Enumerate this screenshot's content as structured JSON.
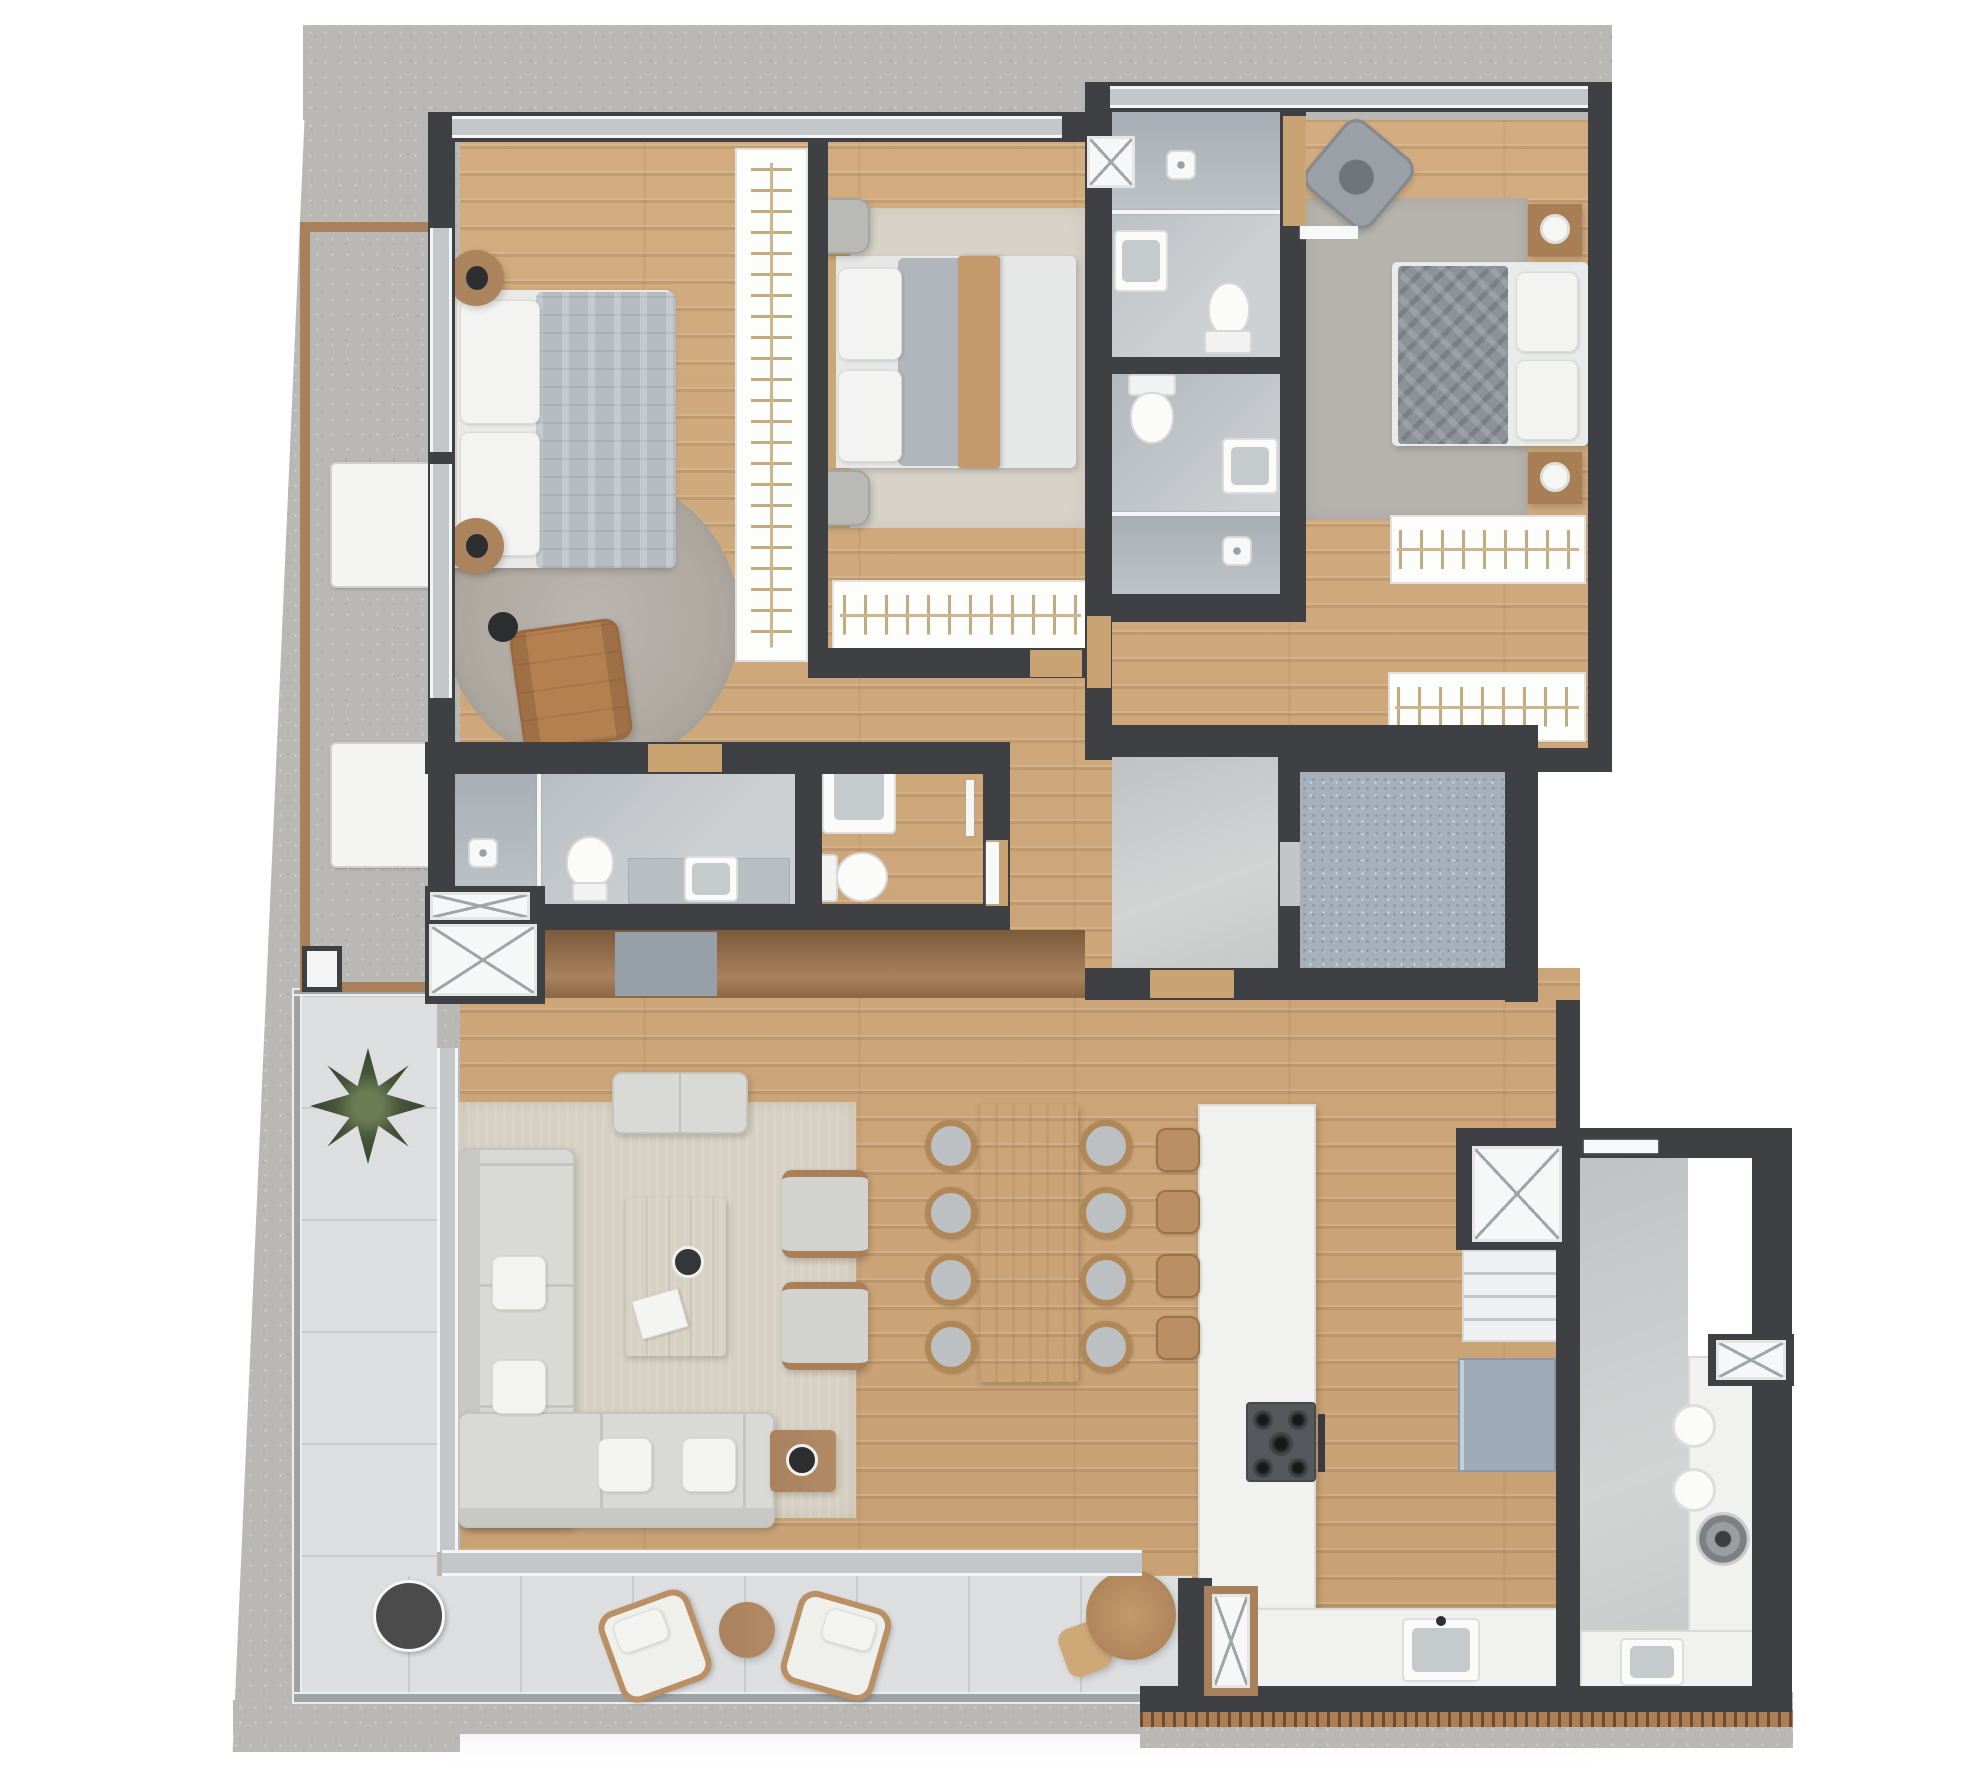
{
  "canvas": {
    "width": 1985,
    "height": 1769
  },
  "palette": {
    "background": "#ffffff",
    "concrete_surround": "#b9b8b5",
    "wall_dark": "#3e4043",
    "wood_floor": "#cba67a",
    "terrace_tile": "#dcdee0",
    "bathroom_floor": "#bcc1c6",
    "shaft_speckle": "#a6b0bb",
    "fixture_white": "#fbfbfa",
    "furniture_wood": "#a9815e",
    "leather_tan": "#b5804f",
    "duvet_gray": "#8b9298",
    "sofa_gray": "#d9d9d5",
    "deck_wood": "#ad7f55"
  },
  "plan": {
    "type": "residential apartment floor plan, 3D top-down render, no text labels",
    "rooms": {
      "bedroom1": "Bedroom with double bed, round rug and leather armchair",
      "bedroom2": "Bedroom with double bed and wardrobe",
      "bedroom3": "Bedroom with double bed, armchair and clothes racks",
      "wardrobe": "Walk-through wardrobe rail",
      "bathroom_a": "Bathroom with shower, vanity and toilet",
      "bathroom_b": "Bathroom with toilet, vanity and shower",
      "master_bathroom": "Bathroom with shower, toilet and vanity counter",
      "powder_room": "Toilet room with sink",
      "hall": "Internal hallway",
      "foyer": "Foyer with smooth gray floor",
      "shaft": "Elevator / stair shaft with speckled floor",
      "living": "Living room with corner sofa",
      "dining": "Dining area with table for eight",
      "kitchen": "Kitchen with island and counters",
      "service": "Service / laundry wing",
      "corridor": "Service corridor",
      "terrace": "L-shaped tiled terrace",
      "tech_balcony": "Technical balcony with AC units"
    },
    "items": {
      "bed_double": "Double bed",
      "pillow": "Pillow",
      "duvet": "Duvet",
      "throw": "Bed throw",
      "nightstand": "Nightstand",
      "lamp": "Table lamp",
      "floor_lamp": "Floor lamp",
      "leather_armchair": "Leather armchair",
      "armchair": "Armchair",
      "rug": "Rug",
      "round_rug": "Round rug",
      "wardrobe_rail": "Wardrobe rail with hangers",
      "clothes_rack": "Clothes rack with hangers",
      "sofa": "L-shaped sectional sofa",
      "bench": "Backless bench",
      "coffee_table": "Coffee table with tray and magazine",
      "side_table": "Side table",
      "sideboard": "Sideboard cabinet",
      "dining_table": "Dining table",
      "dining_chair": "Dining chair",
      "kitchen_island": "Kitchen island",
      "bar_stool": "Bar stool",
      "cooktop": "5-burner gas cooktop",
      "oven_handle": "Oven handle",
      "kitchen_sink": "Kitchen sink",
      "counter": "Kitchen counter",
      "fridge": "Refrigerator",
      "pantry": "Pantry shelving",
      "washer": "Washing machine",
      "laundry_basin": "Laundry basin",
      "laundry_sink": "Laundry sink",
      "service_counter": "Service counter",
      "toilet": "Toilet",
      "vanity": "Vanity sink",
      "sink": "Sink",
      "shower": "Shower area",
      "drain": "Shower drain",
      "glass_screen": "Glass shower screen",
      "vent": "Ventilation shaft",
      "ac_unit": "AC condenser unit",
      "window": "Window / glass door",
      "door": "Door leaf",
      "palm": "Palm plant",
      "lounge_chair": "Wicker lounge chair",
      "round_table": "Round outdoor table",
      "outdoor_stool": "Outdoor stool",
      "dark_table": "Round dark planter table",
      "glass_rail": "Terrace railing",
      "deck_edge": "Wood deck edge",
      "concrete": "Concrete surround"
    },
    "counts": {
      "bedrooms": 3,
      "bath_wet_rooms": 4,
      "toilets": 4,
      "beds": 3,
      "dining_seats": 8,
      "bar_stools": 4,
      "ac_units": 2,
      "lounge_chairs": 2,
      "closet_racks": 2,
      "vent_shafts": 6
    }
  }
}
